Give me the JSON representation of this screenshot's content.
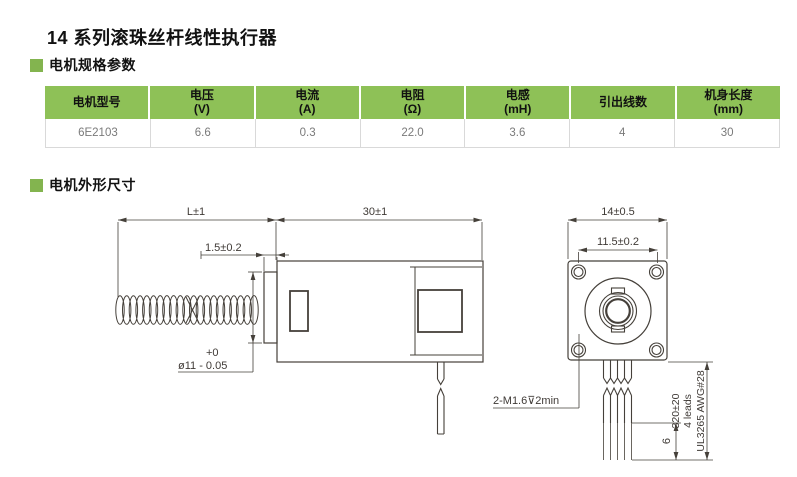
{
  "page": {
    "title": "14 系列滚珠丝杆线性执行器"
  },
  "sections": {
    "specs": "电机规格参数",
    "dims": "电机外形尺寸"
  },
  "table": {
    "headers": [
      {
        "l1": "电机型号",
        "l2": ""
      },
      {
        "l1": "电压",
        "l2": "(V)"
      },
      {
        "l1": "电流",
        "l2": "(A)"
      },
      {
        "l1": "电阻",
        "l2": "(Ω)"
      },
      {
        "l1": "电感",
        "l2": "(mH)"
      },
      {
        "l1": "引出线数",
        "l2": ""
      },
      {
        "l1": "机身长度",
        "l2": "(mm)"
      }
    ],
    "rows": [
      [
        "6E2103",
        "6.6",
        "0.3",
        "22.0",
        "3.6",
        "4",
        "30"
      ]
    ]
  },
  "drawing": {
    "side": {
      "dim_length": "L±1",
      "dim_body": "30±1",
      "dim_boss": "1.5±0.2",
      "dia_tol_plus": "+0",
      "dia_label": "ø11 - 0.05"
    },
    "front": {
      "dim_width": "14±0.5",
      "dim_holes": "11.5±0.2",
      "tap_label": "2-M1.6⊽2min",
      "lead_length": "320±20",
      "lead_count": "4 leads",
      "lead_spec": "UL3265 AWG#28",
      "strip_length": "6"
    }
  },
  "colors": {
    "accent_green": "#8ec157",
    "marker_green": "#83b44f",
    "line": "#45403a"
  }
}
